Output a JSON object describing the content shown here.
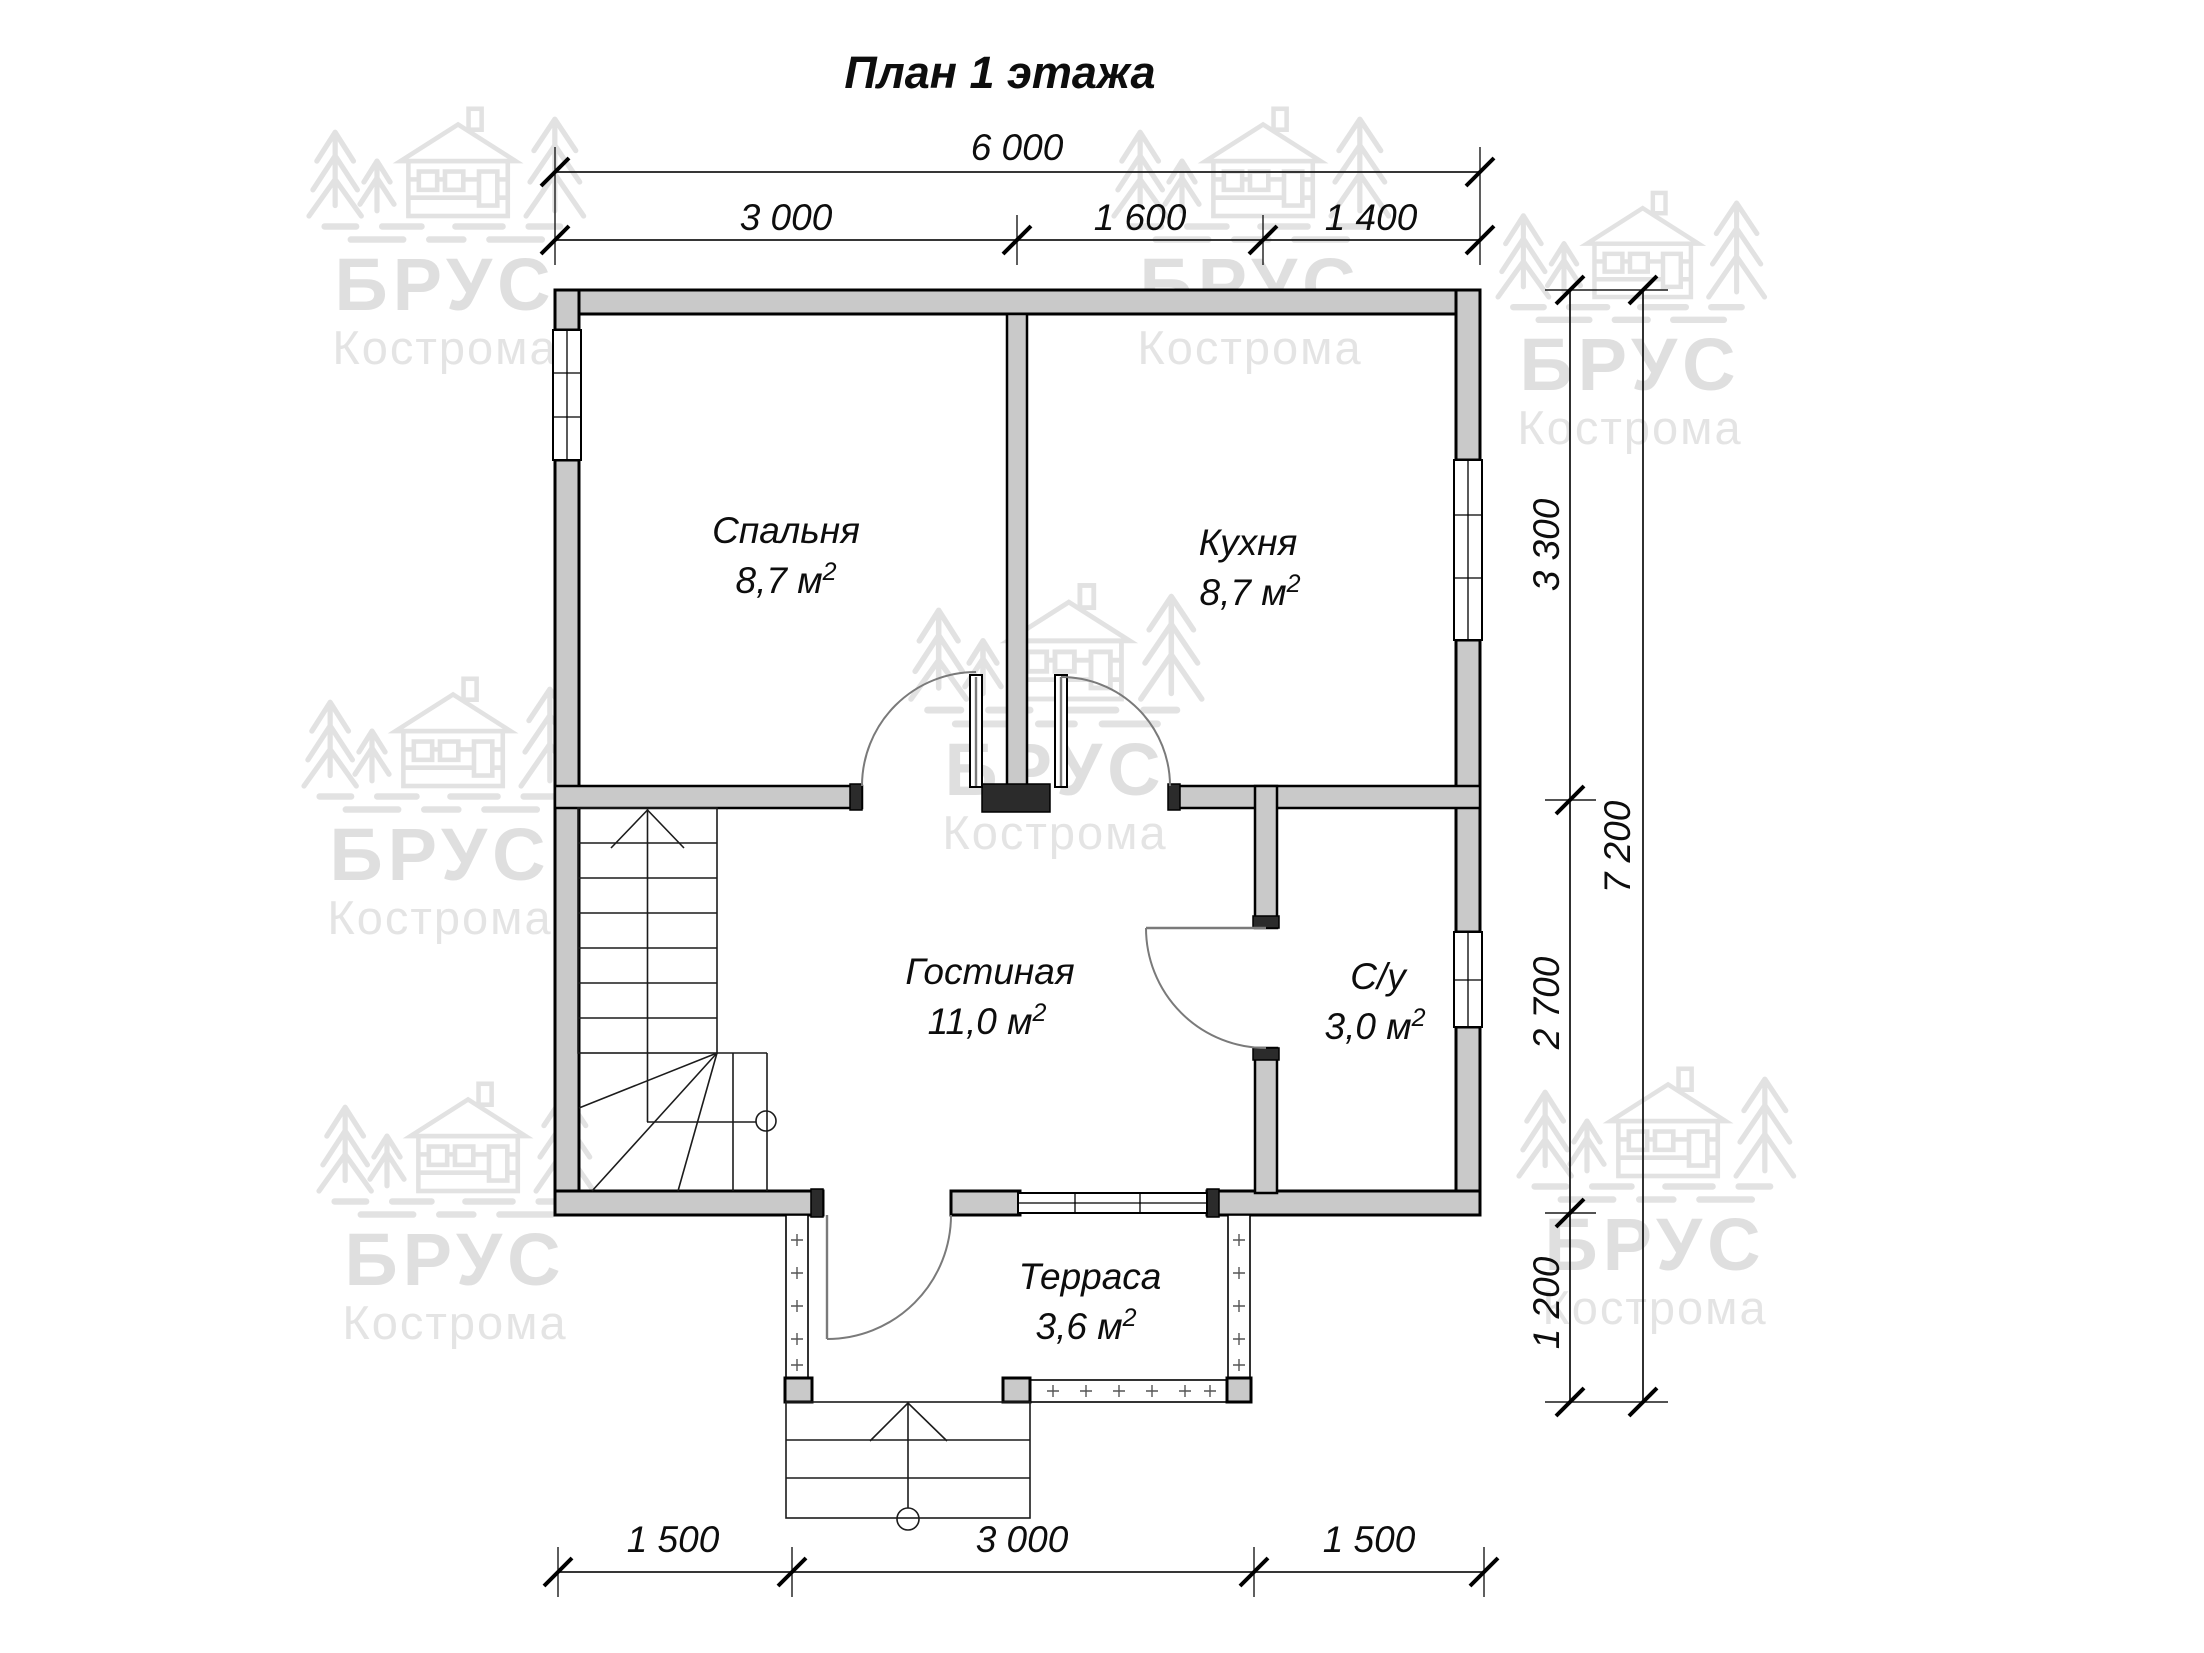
{
  "title": "План 1 этажа",
  "watermark": {
    "brand": "БРУС",
    "city": "Кострома"
  },
  "dimensions": {
    "top_total": "6 000",
    "top_segments": [
      "3 000",
      "1 600",
      "1 400"
    ],
    "right_segments": [
      "3 300",
      "2 700",
      "1 200"
    ],
    "right_total": "7 200",
    "bottom_segments": [
      "1 500",
      "3 000",
      "1 500"
    ]
  },
  "rooms": [
    {
      "name": "Спальня",
      "area": "8,7 м",
      "area_sup": "2"
    },
    {
      "name": "Кухня",
      "area": "8,7 м",
      "area_sup": "2"
    },
    {
      "name": "Гостиная",
      "area": "11,0 м",
      "area_sup": "2"
    },
    {
      "name": "С/у",
      "area": "3,0 м",
      "area_sup": "2"
    },
    {
      "name": "Терраса",
      "area": "3,6 м",
      "area_sup": "2"
    }
  ],
  "colors": {
    "wall_fill": "#c9c9c9",
    "line": "#000000",
    "door_swing": "#7a7a7a",
    "watermark": "#c6c6c6",
    "background": "#ffffff"
  }
}
